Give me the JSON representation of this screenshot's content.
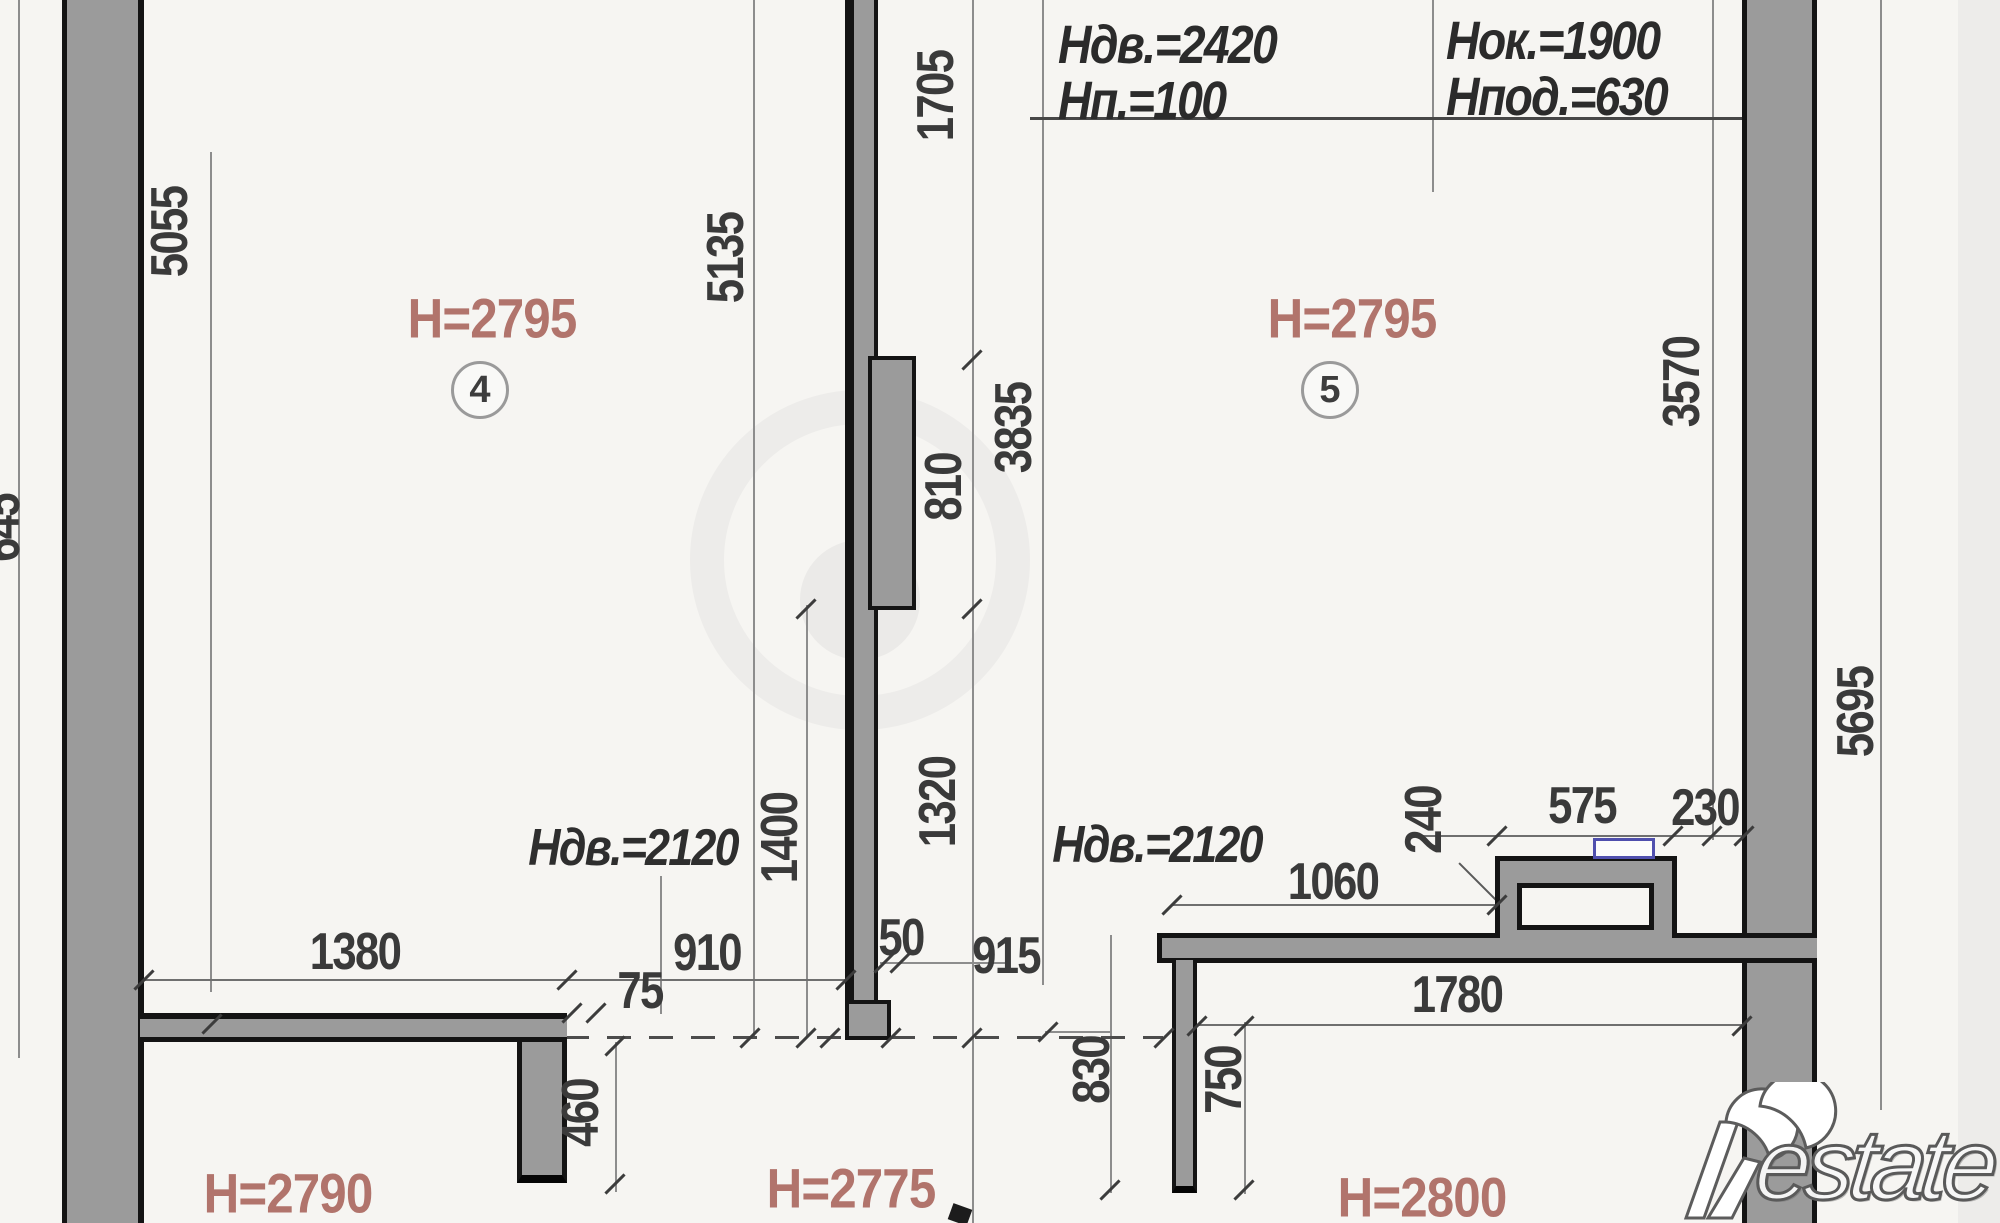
{
  "header_block": {
    "col1": {
      "line1": "Ндв.=2420",
      "line2": "Нп.=100"
    },
    "col2": {
      "line1": "Нок.=1900",
      "line2": "Нпод.=630"
    }
  },
  "rooms": {
    "room4": {
      "number": "4",
      "ceiling": "H=2795"
    },
    "room5": {
      "number": "5",
      "ceiling": "H=2795"
    },
    "room_bottom_left": {
      "ceiling": "H=2790"
    },
    "room_bottom_center": {
      "ceiling": "H=2775"
    },
    "room_bottom_right": {
      "ceiling": "H=2800"
    }
  },
  "door_labels": {
    "left": "Ндв.=2120",
    "right": "Ндв.=2120"
  },
  "dimensions": {
    "v5055": "5055",
    "v5135": "5135",
    "v1705": "1705",
    "v3835": "3835",
    "v810": "810",
    "v1320": "1320",
    "v1400": "1400",
    "v3570": "3570",
    "v5695": "5695",
    "v240": "240",
    "v460": "460",
    "v830": "830",
    "v750": "750",
    "h1380": "1380",
    "h910": "910",
    "h75": "75",
    "h50": "50",
    "h915": "915",
    "h1060": "1060",
    "h575": "575",
    "h230": "230",
    "h1780": "1780",
    "left_partial": "645"
  },
  "watermark": {
    "text": "Restate",
    "rest": "estate"
  },
  "colors": {
    "wall_fill": "#9b9b9b",
    "wall_edge": "#141414",
    "dim_line": "#8d8d8d",
    "dim_text": "#3a3a3a",
    "room_label": "#b1746c",
    "annotation_text": "#2b2b2b",
    "vent_marker_border": "#5050ae",
    "background": "#f6f5f2"
  }
}
